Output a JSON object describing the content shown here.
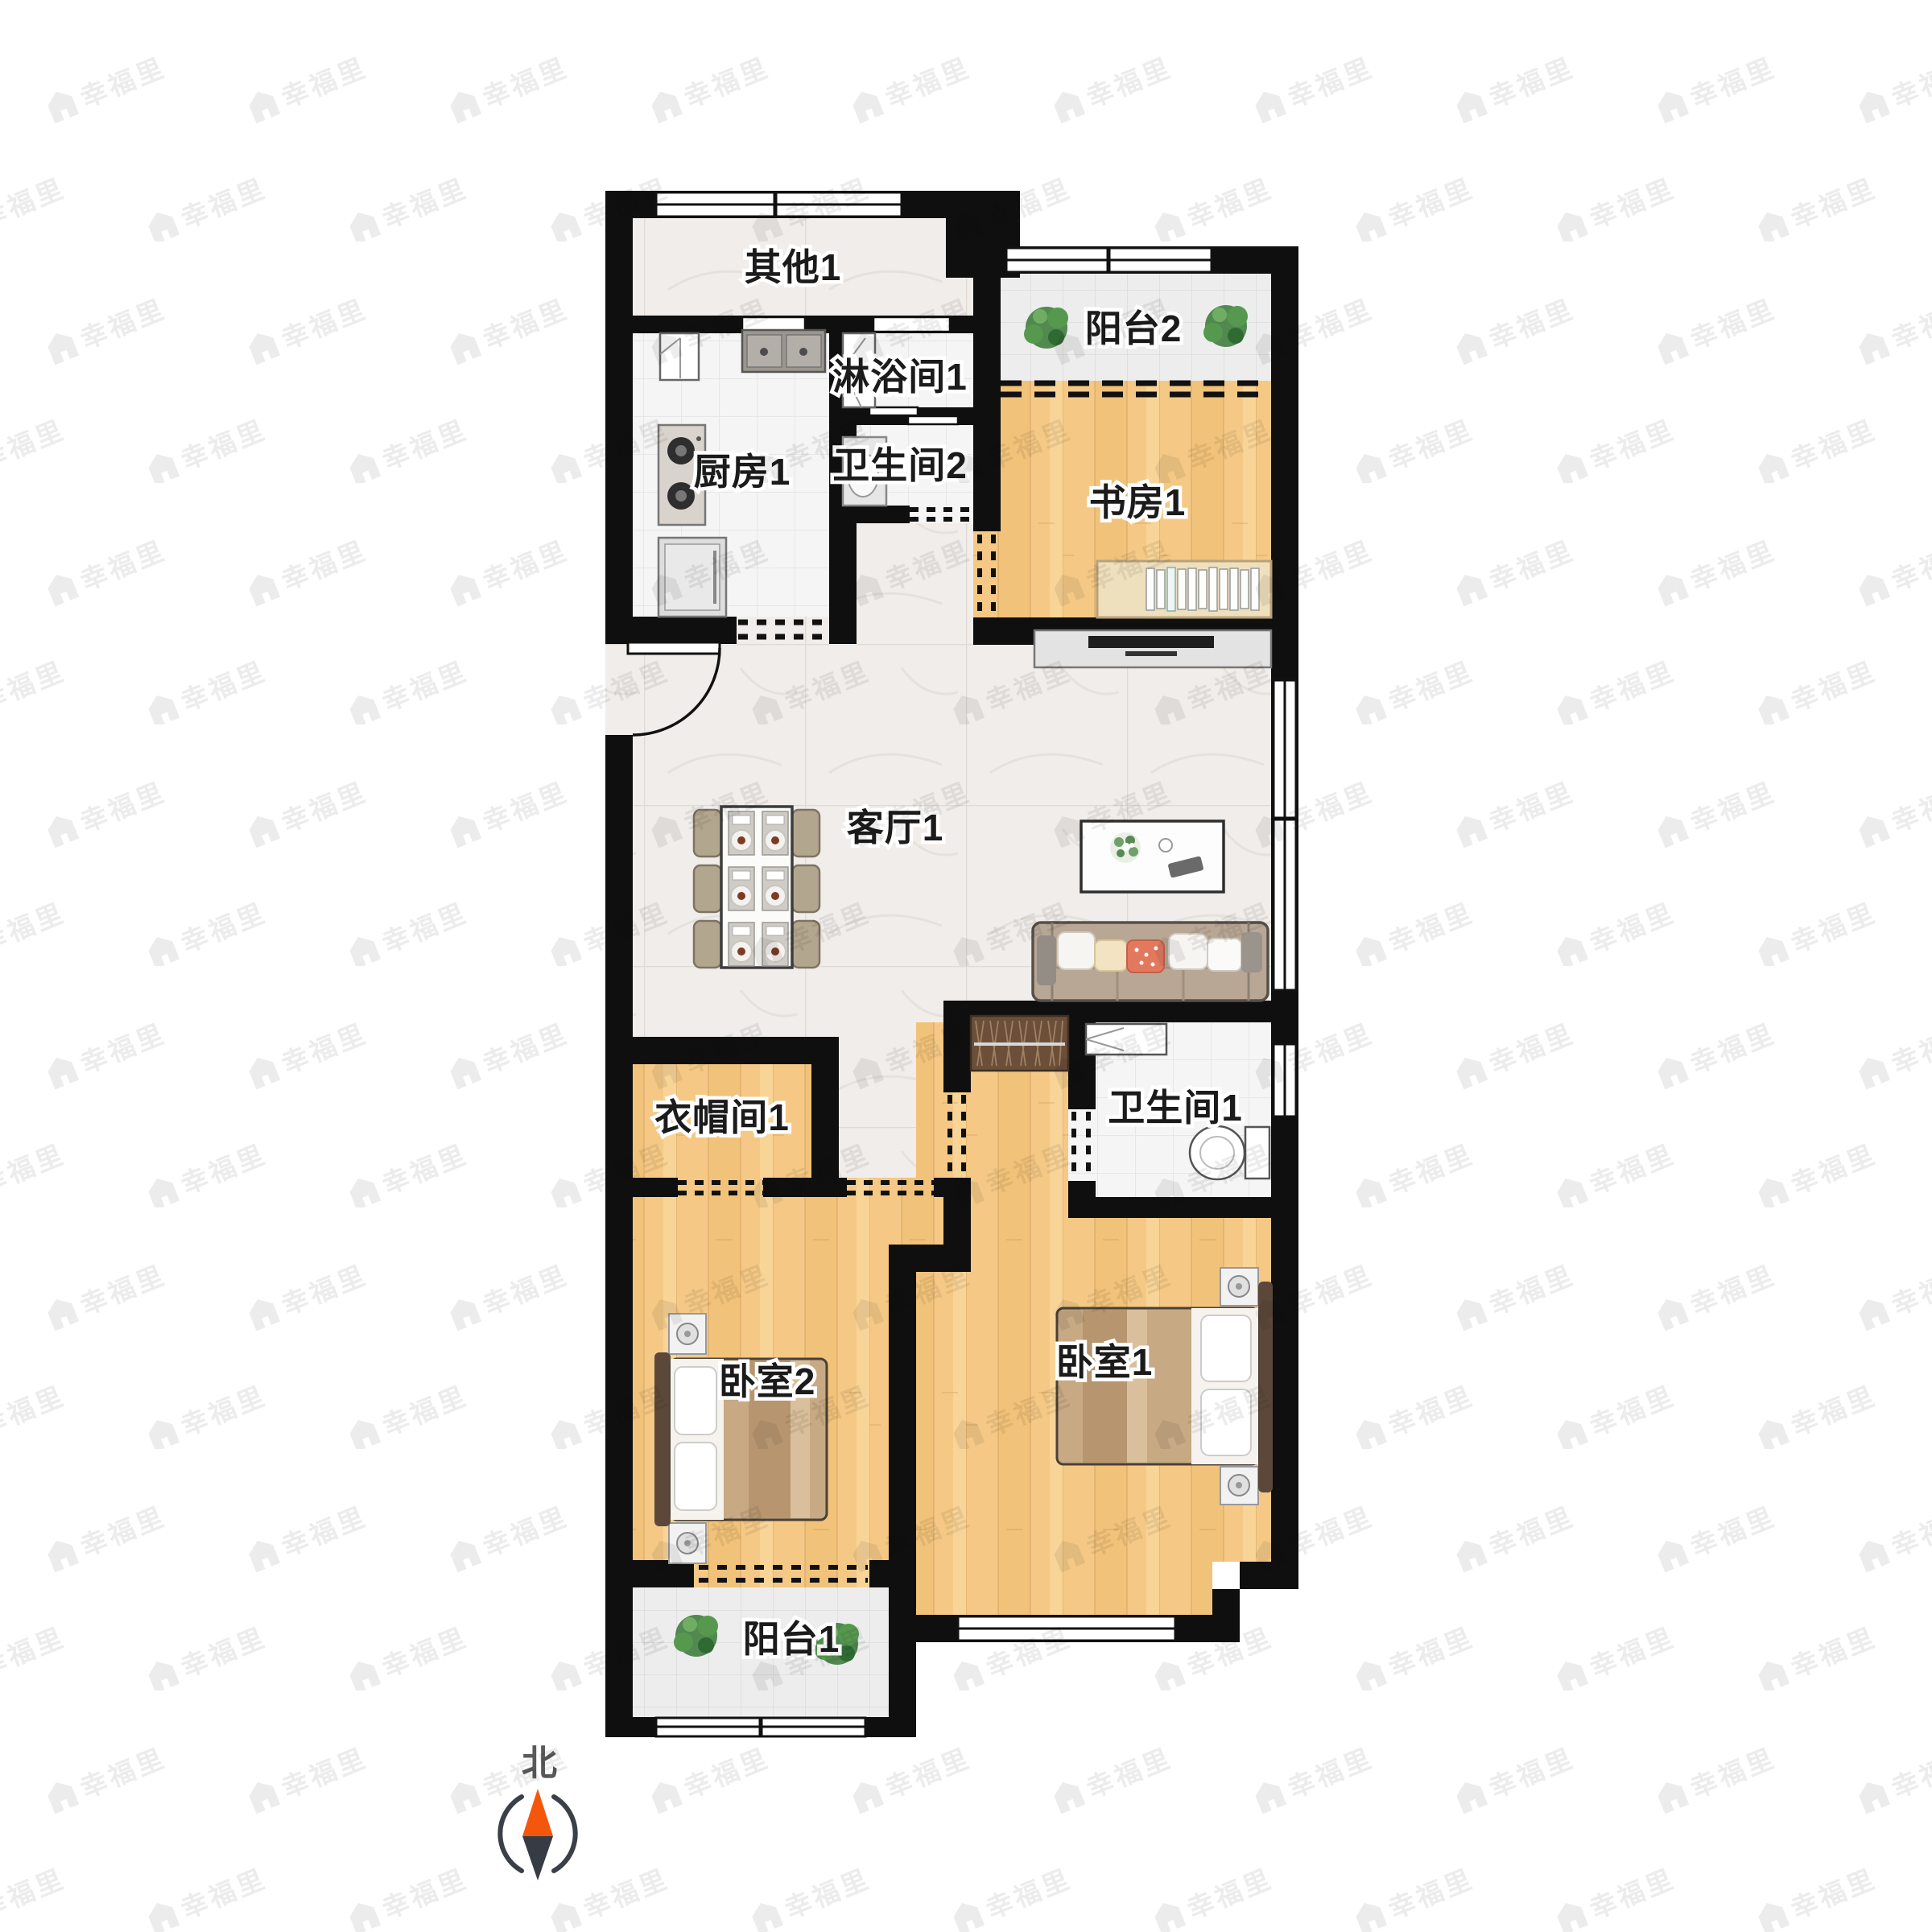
{
  "watermark": {
    "text": "幸福里",
    "icon": "house-icon",
    "color": "#ececec"
  },
  "compass": {
    "label": "北",
    "north_color": "#f4570c",
    "south_color": "#373c44"
  },
  "rooms": {
    "qita1": {
      "label": "其他1",
      "floor": "marble"
    },
    "chufang1": {
      "label": "厨房1",
      "floor": "tile",
      "furniture": [
        "corner-cabinet",
        "double-sink",
        "gas-stove",
        "washing-machine"
      ]
    },
    "linyujian1": {
      "label": "淋浴间1",
      "floor": "tile",
      "furniture": [
        "shower-unit"
      ],
      "door": "sliding"
    },
    "weishengjian2": {
      "label": "卫生间2",
      "floor": "tile",
      "furniture": [
        "washbasin"
      ],
      "door": "dashed-opening"
    },
    "yangtai2": {
      "label": "阳台2",
      "floor": "tile",
      "furniture": [
        "plant",
        "plant"
      ]
    },
    "shufang1": {
      "label": "书房1",
      "floor": "wood",
      "furniture": [
        "desk",
        "books"
      ]
    },
    "keting1": {
      "label": "客厅1",
      "floor": "marble",
      "furniture": [
        "dining-table",
        "chairs-x6",
        "coffee-table",
        "sofa",
        "tv-console"
      ]
    },
    "yimaojian1": {
      "label": "衣帽间1",
      "floor": "wood",
      "door": "dashed-opening"
    },
    "weishengjian1": {
      "label": "卫生间1",
      "floor": "tile",
      "furniture": [
        "washbasin",
        "toilet"
      ],
      "door": "dashed-opening"
    },
    "woshi2": {
      "label": "卧室2",
      "floor": "wood",
      "furniture": [
        "double-bed",
        "nightstand",
        "nightstand"
      ]
    },
    "woshi1": {
      "label": "卧室1",
      "floor": "wood",
      "furniture": [
        "double-bed",
        "nightstand",
        "nightstand",
        "wardrobe"
      ]
    },
    "yangtai1": {
      "label": "阳台1",
      "floor": "tile",
      "furniture": [
        "plant",
        "plant"
      ]
    }
  },
  "colors": {
    "wall": "#0f0f0f",
    "wood_floor": "#f5c985",
    "marble_floor": "#f0edea",
    "tile_floor": "#f5f5f6",
    "balcony_tile": "#ededed",
    "bed_blanket": "#c7a983",
    "sofa": "#b9a795",
    "plant": "#4c8a46"
  }
}
